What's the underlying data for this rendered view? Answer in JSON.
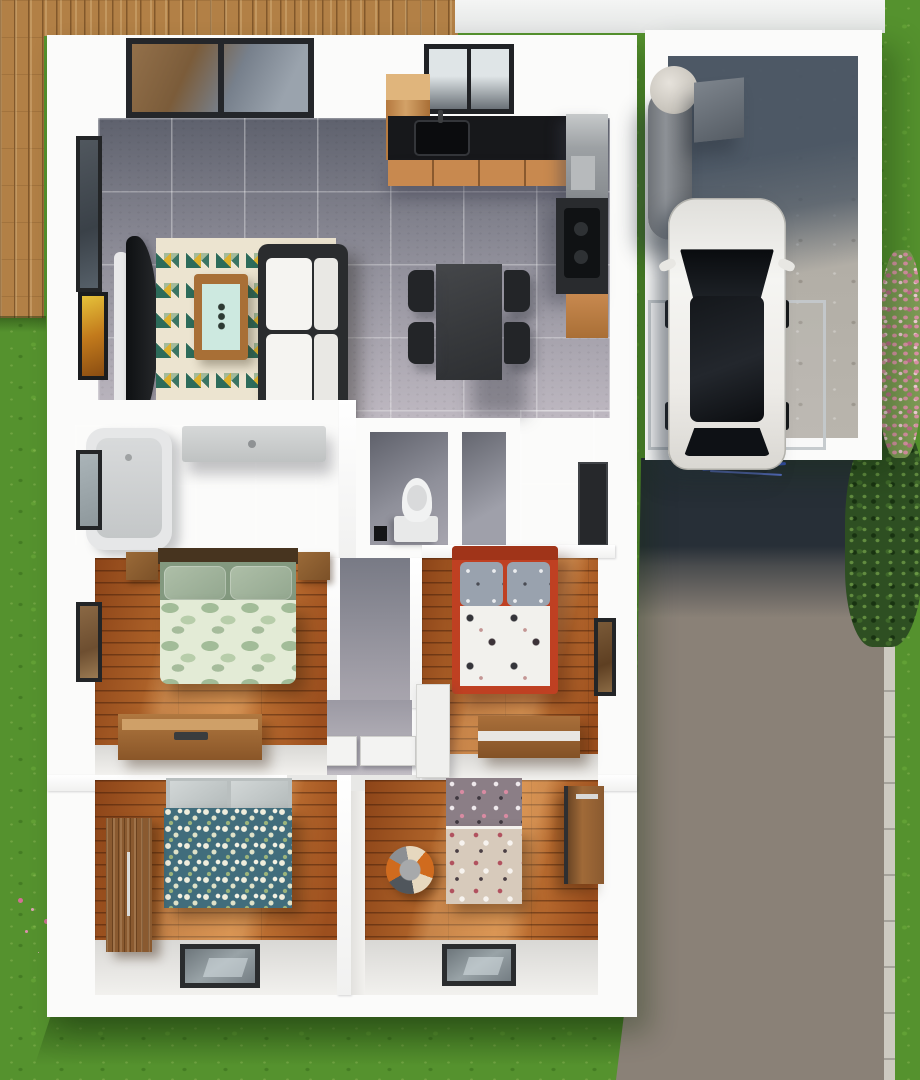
{
  "scene": {
    "title": "3D rendered top-down floor plan of a house with garage, driveway and lawn",
    "view": "top-down 3d render",
    "text_labels": []
  },
  "colors": {
    "grass_base": "#55922e",
    "deck_wood": "#b28046",
    "deck_line": "#82582b",
    "wall_white": "#fbfbfa",
    "tile_dark": "#5e616d",
    "tile_mid": "#908f9a",
    "tile_light": "#beb8c1",
    "wood_floor_dark": "#8c4418",
    "wood_floor_mid": "#b4682c",
    "wood_floor_light": "#cd7f3b",
    "rug_cream": "#ece4d0",
    "rug_teal": "#2d6b5a",
    "rug_yellow": "#ddb02c",
    "rug_sage": "#a3bb9b",
    "sofa_frame": "#2a2c2e",
    "sofa_cushion": "#f5f4f1",
    "coffee_wood": "#a86f36",
    "coffee_top": "#cde9e0",
    "chair_dark": "#232528",
    "counter_dark": "#17181b",
    "cabinet_wood": "#c8894f",
    "frame_dark": "#232527",
    "headboard_dark": "#47341f",
    "bed_green_dark": "#83997f",
    "bed_green_light": "#e3ebd6",
    "bed_red_frame": "#bf4022",
    "pillow_gray": "#99a2ae",
    "duvet_white": "#f2f1ed",
    "bed_teal": "#416d7c",
    "bed_teal_dot": "#efeddc",
    "bed_pink_top": "#8b7e86",
    "bed_pink_bottom": "#d7cabb",
    "ottoman_orange": "#d06b1e",
    "ottoman_gray": "#50565c",
    "ottoman_cream": "#e6d8bf",
    "wardrobe_wood": "#8a5a30",
    "concrete": "#b9b5ad",
    "driveway": "#8a8177",
    "driveway_shadow": "#272f37",
    "curb": "#cdcac1",
    "bush_green": "#2e4f22",
    "bush_pink": "#dd93a8",
    "bike_blue": "#3b55c8",
    "hall_door": "#f3f3f2"
  },
  "rooms": [
    {
      "id": "living-room",
      "floor": "gray-tile",
      "furniture": [
        "triangle-pattern-rug",
        "sofa",
        "coffee-table",
        "tv-stand",
        "wall-art",
        "window"
      ]
    },
    {
      "id": "kitchen",
      "floor": "gray-tile",
      "furniture": [
        "l-shaped-counter",
        "sink",
        "window",
        "fridge",
        "stove",
        "cabinets"
      ]
    },
    {
      "id": "dining-area",
      "floor": "gray-tile",
      "furniture": [
        "dark-table",
        "four-chairs"
      ]
    },
    {
      "id": "bathroom",
      "floor": "gray-tile",
      "furniture": [
        "bathtub",
        "vanity-counter",
        "window"
      ]
    },
    {
      "id": "wc",
      "floor": "gray-tile",
      "furniture": [
        "toilet",
        "waste-bin"
      ]
    },
    {
      "id": "closet",
      "floor": "gray-tile",
      "furniture": []
    },
    {
      "id": "hallway",
      "floor": "gray-tile",
      "furniture": [
        "open-door",
        "open-door"
      ]
    },
    {
      "id": "bedroom-green",
      "floor": "wood-plank",
      "furniture": [
        "double-bed-green-leaf-duvet",
        "nightstand",
        "nightstand",
        "dresser",
        "window"
      ]
    },
    {
      "id": "bedroom-red",
      "floor": "wood-plank",
      "furniture": [
        "double-bed-red-frame",
        "dresser",
        "white-desk",
        "window"
      ]
    },
    {
      "id": "bedroom-teal",
      "floor": "wood-plank",
      "furniture": [
        "bed-teal-floral-duvet",
        "wardrobe",
        "window"
      ]
    },
    {
      "id": "bedroom-pink",
      "floor": "wood-plank",
      "furniture": [
        "single-bed-pink-pattern",
        "ball-ottoman",
        "desk",
        "window"
      ]
    },
    {
      "id": "garage",
      "floor": "concrete",
      "furniture": [
        "white-car",
        "water-tank",
        "water-heater",
        "glass-door-frame"
      ]
    }
  ],
  "exterior": {
    "features": [
      "wood-deck",
      "lawn",
      "top-path",
      "driveway",
      "curb",
      "green-shrubs",
      "pink-flowering-bush",
      "grass-flowers",
      "bicycle"
    ]
  }
}
